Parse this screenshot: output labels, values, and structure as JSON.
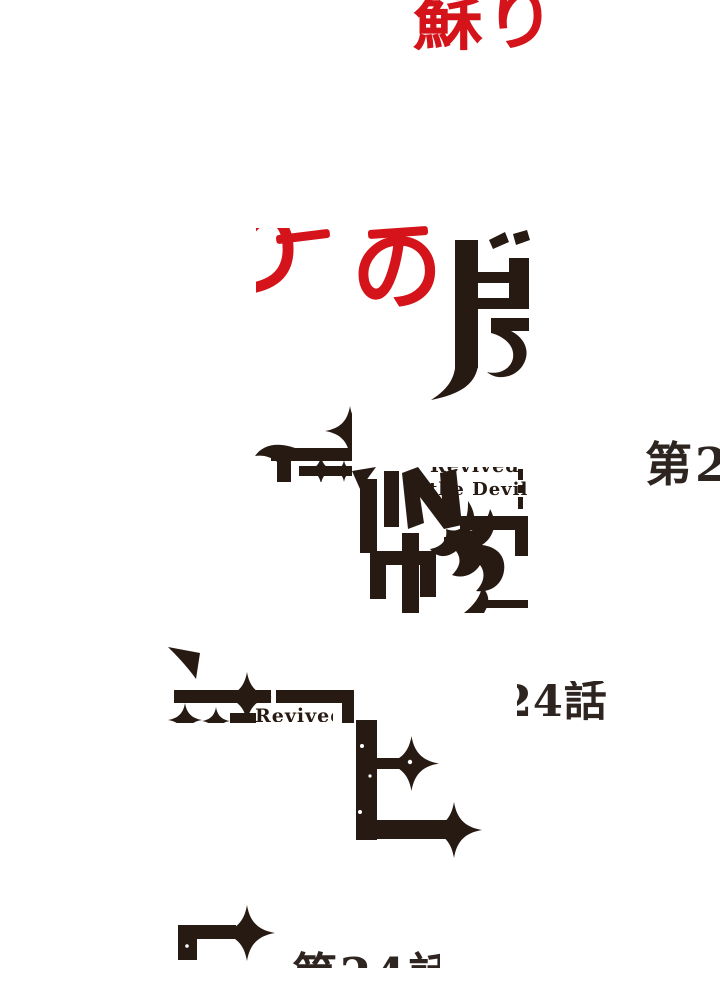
{
  "colors": {
    "red": "#d4131a",
    "ink": "#271a13",
    "episode_ink": "#2e2521"
  },
  "title": {
    "red_top": "蘇り",
    "red_ri": "り",
    "red_no": "の",
    "subtitle_word": "Revived",
    "subtitle_line": "the Devil",
    "subtitle_word_lower": "Revived"
  },
  "episode": {
    "right_fragment": "第2",
    "middle_fragment": "24話",
    "bottom_fragment": "第24話"
  }
}
